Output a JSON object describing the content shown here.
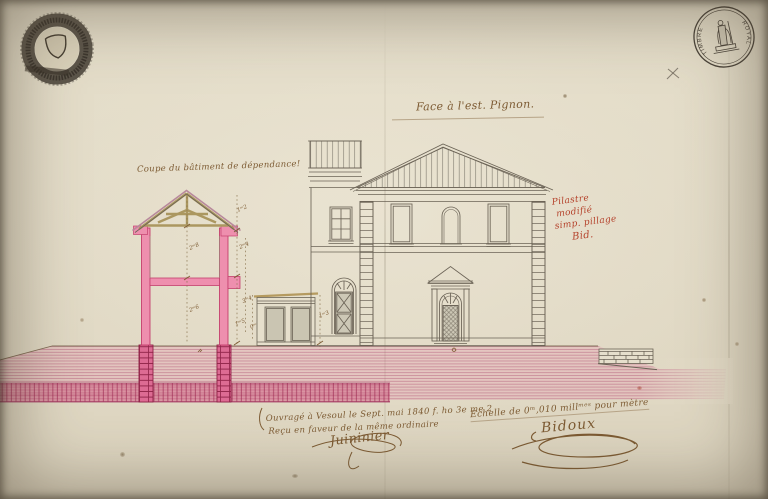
{
  "page": {
    "title": "Face à l'est. Pignon.",
    "section_label": "Coupe du bâtiment de dépendance!",
    "red_note": {
      "line1": "Pilastre",
      "line2": "modifié",
      "line3": "simp. pillage",
      "line4": "Bid."
    },
    "bottom_note": {
      "line1": "Ouvragé à Vesoul le Sept. mai 1840 f. ho 3e me 2",
      "line2": "Reçu en faveur de la même ordinaire",
      "signature": "Juininier"
    },
    "scale_note": {
      "text": "Echelle de 0ᵐ,010 millᵐᵉˢ pour mètre",
      "signature": "Bidoux"
    },
    "stamps": {
      "top_left": "embossed circular seal with shield",
      "top_right_left_arc": "TIMBRE",
      "top_right_right_arc": "ROYAL"
    },
    "pencil_mark": "×",
    "dimensions": {
      "d1": "2ᵐ8",
      "d2": "2ᵐ6",
      "d3": "1ᵐ2",
      "d4": "2ᵐ4",
      "d5": "3ᵐ4",
      "d6": "1ᵐ5",
      "d7": "0ᵐ6",
      "d8": "1ᵐ3"
    },
    "colors": {
      "paper": "#e2dac6",
      "ink_line": "#6b6356",
      "ink_brown": "#7d5b33",
      "ink_red": "#b5432c",
      "wall_pink": "#ee8fae",
      "wall_outline": "#c43f6d",
      "ground_wash": "#dd7b98",
      "wood_tan": "#ab9760"
    }
  }
}
